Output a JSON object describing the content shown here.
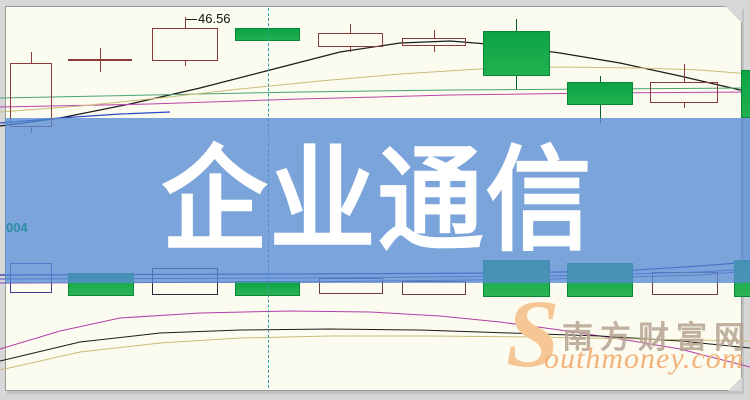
{
  "banner": {
    "title": "企业通信",
    "color": "#7aa5dc",
    "text_color": "#ffffff"
  },
  "watermark": {
    "logo_letter": "S",
    "site_name_cn": "南方财富网",
    "site_name_en": "outhmoney.com",
    "accent_color": "#f2b27a"
  },
  "chart": {
    "price_label": "46.56",
    "axis_label": "004",
    "colors": {
      "page_bg": "#fcfbef",
      "frame_bg": "#d7d7d7",
      "up_candle_border": "#8d3a3a",
      "down_candle_fill": "#0da344",
      "down_candle_wick": "#07602c",
      "crosshair": "#2f9ca8",
      "axis_label_color": "#2c8fa6"
    },
    "chart_data": {
      "type": "candlestick",
      "note": "no numeric axes visible; geometry captured in image pixel coords (y down)",
      "crosshair_x": 268,
      "gridlines_y": [
        152,
        200,
        248
      ],
      "candles": [
        {
          "cx": 31,
          "w": 42,
          "body_top": 63,
          "body_bottom": 127,
          "wick_top": 52,
          "wick_bottom": 133,
          "type": "up"
        },
        {
          "cx": 100,
          "w": 64,
          "body_top": 59,
          "body_bottom": 61,
          "wick_top": 48,
          "wick_bottom": 72,
          "type": "up"
        },
        {
          "cx": 185,
          "w": 66,
          "body_top": 28,
          "body_bottom": 61,
          "wick_top": 17,
          "wick_bottom": 66,
          "type": "up"
        },
        {
          "cx": 267,
          "w": 65,
          "body_top": 28,
          "body_bottom": 41,
          "wick_top": 28,
          "wick_bottom": 41,
          "type": "down"
        },
        {
          "cx": 350,
          "w": 65,
          "body_top": 33,
          "body_bottom": 47,
          "wick_top": 24,
          "wick_bottom": 52,
          "type": "up"
        },
        {
          "cx": 434,
          "w": 64,
          "body_top": 38,
          "body_bottom": 46,
          "wick_top": 30,
          "wick_bottom": 52,
          "type": "up"
        },
        {
          "cx": 516,
          "w": 67,
          "body_top": 31,
          "body_bottom": 76,
          "wick_top": 19,
          "wick_bottom": 89,
          "type": "down"
        },
        {
          "cx": 600,
          "w": 66,
          "body_top": 82,
          "body_bottom": 105,
          "wick_top": 76,
          "wick_bottom": 123,
          "type": "down"
        },
        {
          "cx": 684,
          "w": 68,
          "body_top": 82,
          "body_bottom": 103,
          "wick_top": 64,
          "wick_bottom": 108,
          "type": "up"
        },
        {
          "cx": 746,
          "w": 10,
          "body_top": 70,
          "body_bottom": 118,
          "wick_top": 70,
          "wick_bottom": 118,
          "type": "down"
        }
      ],
      "volume_bars": [
        {
          "cx": 31,
          "w": 42,
          "top": 263,
          "bottom": 293,
          "style": "hollow",
          "border": "#3c3c8f"
        },
        {
          "cx": 101,
          "w": 66,
          "top": 273,
          "bottom": 296,
          "style": "filled"
        },
        {
          "cx": 185,
          "w": 66,
          "top": 268,
          "bottom": 295,
          "style": "hollow",
          "border": "#2a2a3a"
        },
        {
          "cx": 267,
          "w": 65,
          "top": 281,
          "bottom": 296,
          "style": "filled"
        },
        {
          "cx": 351,
          "w": 64,
          "top": 278,
          "bottom": 294,
          "style": "hollow",
          "border": "#6d3a49"
        },
        {
          "cx": 434,
          "w": 64,
          "top": 281,
          "bottom": 295,
          "style": "hollow",
          "border": "#6d3a49"
        },
        {
          "cx": 516,
          "w": 67,
          "top": 260,
          "bottom": 297,
          "style": "filled"
        },
        {
          "cx": 600,
          "w": 66,
          "top": 263,
          "bottom": 297,
          "style": "filled"
        },
        {
          "cx": 685,
          "w": 66,
          "top": 272,
          "bottom": 295,
          "style": "hollow",
          "border": "#6d3a49"
        },
        {
          "cx": 742,
          "w": 17,
          "top": 260,
          "bottom": 297,
          "style": "filled"
        }
      ],
      "lines": [
        {
          "name": "price-ma-black",
          "color": "#1a1a1a",
          "width": 1.2,
          "points": [
            [
              0,
              126
            ],
            [
              60,
              118
            ],
            [
              130,
              104
            ],
            [
              200,
              88
            ],
            [
              270,
              70
            ],
            [
              340,
              52
            ],
            [
              400,
              43
            ],
            [
              450,
              41
            ],
            [
              500,
              45
            ],
            [
              560,
              53
            ],
            [
              620,
              63
            ],
            [
              680,
              76
            ],
            [
              740,
              90
            ],
            [
              750,
              92
            ]
          ]
        },
        {
          "name": "price-ma-magenta",
          "color": "#bb44aa",
          "width": 1,
          "points": [
            [
              0,
              107
            ],
            [
              150,
              104
            ],
            [
              300,
              99
            ],
            [
              450,
              95
            ],
            [
              600,
              93
            ],
            [
              750,
              92
            ]
          ]
        },
        {
          "name": "price-ma-teal",
          "color": "#4aa273",
          "width": 1,
          "points": [
            [
              0,
              98
            ],
            [
              150,
              95
            ],
            [
              300,
              92
            ],
            [
              450,
              90
            ],
            [
              600,
              89
            ],
            [
              750,
              88
            ]
          ]
        },
        {
          "name": "price-ma-khaki",
          "color": "#c9bc79",
          "width": 1,
          "points": [
            [
              0,
              112
            ],
            [
              80,
              106
            ],
            [
              160,
              98
            ],
            [
              240,
              89
            ],
            [
              320,
              81
            ],
            [
              400,
              74
            ],
            [
              480,
              69
            ],
            [
              560,
              67
            ],
            [
              640,
              68
            ],
            [
              700,
              70
            ],
            [
              750,
              74
            ]
          ]
        },
        {
          "name": "price-ma-blue",
          "color": "#2b4bc8",
          "width": 1.2,
          "points": [
            [
              0,
              123
            ],
            [
              60,
              118
            ],
            [
              120,
              114
            ],
            [
              170,
              112
            ]
          ]
        },
        {
          "name": "volume-ma-navy-1",
          "color": "#2626a8",
          "width": 1.2,
          "points": [
            [
              0,
              275
            ],
            [
              300,
              274
            ],
            [
              500,
              273
            ],
            [
              620,
              271
            ],
            [
              700,
              266
            ],
            [
              750,
              262
            ]
          ]
        },
        {
          "name": "volume-ma-navy-2",
          "color": "#4646c8",
          "width": 1,
          "points": [
            [
              0,
              279
            ],
            [
              300,
              278
            ],
            [
              550,
              276
            ],
            [
              700,
              272
            ],
            [
              750,
              269
            ]
          ]
        },
        {
          "name": "volume-ma-violet",
          "color": "#7a3fae",
          "width": 1,
          "points": [
            [
              0,
              283
            ],
            [
              300,
              282
            ],
            [
              550,
              279
            ],
            [
              700,
              275
            ],
            [
              750,
              271
            ]
          ]
        },
        {
          "name": "indicator-magenta",
          "color": "#b040a8",
          "width": 1,
          "points": [
            [
              0,
              349
            ],
            [
              60,
              331
            ],
            [
              120,
              318
            ],
            [
              200,
              313
            ],
            [
              290,
              311
            ],
            [
              370,
              312
            ],
            [
              440,
              316
            ],
            [
              500,
              322
            ],
            [
              560,
              330
            ],
            [
              620,
              339
            ],
            [
              680,
              349
            ],
            [
              750,
              367
            ]
          ]
        },
        {
          "name": "indicator-black",
          "color": "#1a1a1a",
          "width": 1,
          "points": [
            [
              0,
              361
            ],
            [
              80,
              342
            ],
            [
              160,
              333
            ],
            [
              240,
              330
            ],
            [
              330,
              329
            ],
            [
              420,
              330
            ],
            [
              510,
              333
            ],
            [
              600,
              336
            ],
            [
              680,
              341
            ],
            [
              750,
              348
            ]
          ]
        },
        {
          "name": "indicator-khaki",
          "color": "#c9bc79",
          "width": 1,
          "points": [
            [
              0,
              370
            ],
            [
              80,
              352
            ],
            [
              160,
              343
            ],
            [
              240,
              338
            ],
            [
              330,
              336
            ],
            [
              430,
              336
            ],
            [
              530,
              337
            ],
            [
              640,
              339
            ],
            [
              750,
              341
            ]
          ]
        }
      ]
    }
  }
}
